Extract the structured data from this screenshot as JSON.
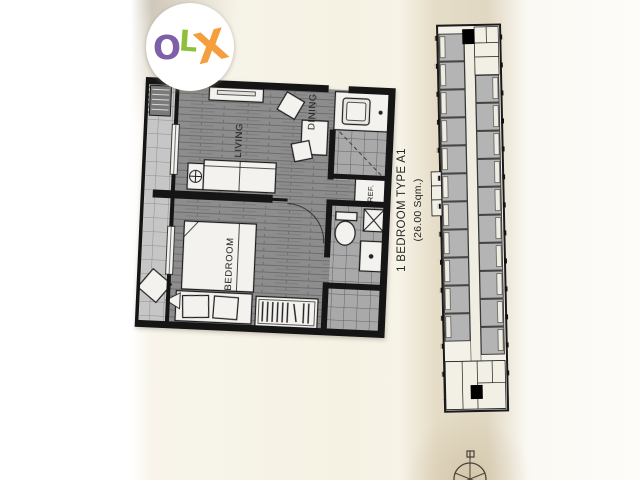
{
  "watermark": {
    "brand": "OLX",
    "letters": {
      "o": "O",
      "l": "L",
      "x": "X"
    },
    "colors": {
      "o": "#7d60a8",
      "l": "#8fc03c",
      "x": "#f59e3e",
      "circle": "#ffffff"
    }
  },
  "floorplan": {
    "title": "1 BEDROOM TYPE A1",
    "area": "(26.00 Sqm.)",
    "rooms": {
      "living": "LIVING",
      "dining": "DINING",
      "bedroom": "BEDROOM",
      "fridge": "REF."
    }
  },
  "colors": {
    "paper": "#f6f2e6",
    "paper_shadow": "#d5c8a8",
    "wall": "#151515",
    "wood_floor": "#8d8d8d",
    "tile_floor": "#a9a9a9",
    "balcony_tile": "#c6c6c6",
    "keyplan_unit": "#b4b4b4",
    "keyplan_highlight": "#000000"
  }
}
